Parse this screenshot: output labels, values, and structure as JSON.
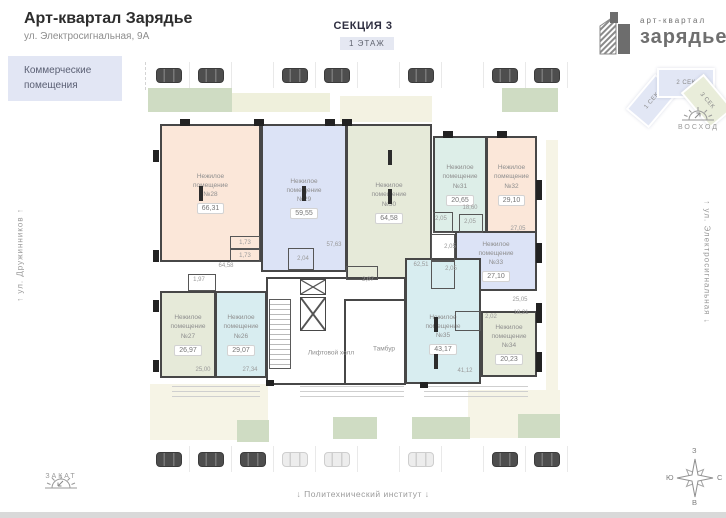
{
  "header": {
    "title": "Арт-квартал Зарядье",
    "subtitle": "ул. Электросигнальная, 9А",
    "badge": "Коммерческие помещения"
  },
  "section_header": {
    "title": "СЕКЦИЯ 3",
    "floor_badge": "1 ЭТАЖ"
  },
  "logo": {
    "top_text": "арт-квартал",
    "bottom_text": "зарядье"
  },
  "section_picker": [
    {
      "label": "1 СЕК",
      "active": false
    },
    {
      "label": "2 СЕК",
      "active": false
    },
    {
      "label": "3 СЕК",
      "active": true
    }
  ],
  "surroundings": {
    "sunrise_label": "ВОСХОД",
    "sunset_label": "ЗАКАТ",
    "street_left": "↑  ул. Дружинников  ↑",
    "street_right": "↑  ул. Электросигнальная  ↓",
    "landmark_bottom": "↓ Политехнический институт ↓",
    "compass": {
      "top": "З",
      "left": "Ю",
      "right": "С",
      "bottom": "В"
    }
  },
  "colors": {
    "peach": "#fbe7d9",
    "lavender": "#dce3f6",
    "sage": "#e6ead9",
    "mint": "#ddeee8",
    "cyan": "#d8edf0"
  },
  "plan": {
    "room_type_label": "Нежилое помещение",
    "rooms": [
      {
        "number": "№28",
        "area": "66,31",
        "color": "peach",
        "rect": [
          160,
          124,
          101,
          138
        ]
      },
      {
        "number": "№29",
        "area": "59,55",
        "color": "lavender",
        "rect": [
          261,
          124,
          86,
          148
        ]
      },
      {
        "number": "№30",
        "area": "64,58",
        "color": "sage",
        "rect": [
          346,
          124,
          86,
          157
        ]
      },
      {
        "number": "№31",
        "area": "20,65",
        "color": "mint",
        "rect": [
          433,
          136,
          54,
          97
        ]
      },
      {
        "number": "№32",
        "area": "29,10",
        "color": "peach",
        "rect": [
          486,
          136,
          51,
          97
        ]
      },
      {
        "number": "№33",
        "area": "27,10",
        "color": "lavender",
        "rect": [
          455,
          231,
          82,
          60
        ]
      },
      {
        "number": "№27",
        "area": "26,97",
        "color": "sage",
        "rect": [
          160,
          291,
          56,
          87
        ]
      },
      {
        "number": "№26",
        "area": "29,07",
        "color": "cyan",
        "rect": [
          215,
          291,
          52,
          87
        ]
      },
      {
        "number": "№35",
        "area": "43,17",
        "color": "cyan",
        "rect": [
          405,
          258,
          76,
          126
        ],
        "padTop": 26
      },
      {
        "number": "№34",
        "area": "20,23",
        "color": "sage",
        "rect": [
          481,
          311,
          56,
          66
        ]
      }
    ],
    "halls": [
      {
        "name": "Лифтовой холл",
        "pos": [
          331,
          353
        ]
      },
      {
        "name": "Тамбур",
        "pos": [
          384,
          349
        ]
      }
    ],
    "small_rooms": [
      [
        230,
        236,
        30,
        13
      ],
      [
        230,
        249,
        30,
        13
      ],
      [
        288,
        248,
        26,
        22
      ],
      [
        346,
        266,
        32,
        14
      ],
      [
        433,
        212,
        20,
        21
      ],
      [
        459,
        214,
        24,
        19
      ],
      [
        431,
        234,
        24,
        27
      ],
      [
        431,
        261,
        24,
        28
      ],
      [
        455,
        311,
        26,
        20
      ],
      [
        188,
        274,
        28,
        17
      ]
    ],
    "sub_labels": [
      {
        "text": "64,58",
        "x": 226,
        "y": 266
      },
      {
        "text": "1,73",
        "x": 245,
        "y": 243
      },
      {
        "text": "1,73",
        "x": 245,
        "y": 256
      },
      {
        "text": "2,04",
        "x": 303,
        "y": 259
      },
      {
        "text": "57,63",
        "x": 334,
        "y": 245
      },
      {
        "text": "62,51",
        "x": 421,
        "y": 265
      },
      {
        "text": "2,07",
        "x": 368,
        "y": 280
      },
      {
        "text": "2,05",
        "x": 441,
        "y": 219
      },
      {
        "text": "18,60",
        "x": 470,
        "y": 208
      },
      {
        "text": "2,05",
        "x": 470,
        "y": 222
      },
      {
        "text": "27,05",
        "x": 518,
        "y": 229
      },
      {
        "text": "2,05",
        "x": 450,
        "y": 247
      },
      {
        "text": "2,05",
        "x": 451,
        "y": 269
      },
      {
        "text": "25,05",
        "x": 520,
        "y": 300
      },
      {
        "text": "2,02",
        "x": 491,
        "y": 317
      },
      {
        "text": "18,21",
        "x": 521,
        "y": 313
      },
      {
        "text": "1,97",
        "x": 199,
        "y": 280
      },
      {
        "text": "25,00",
        "x": 203,
        "y": 370
      },
      {
        "text": "27,34",
        "x": 250,
        "y": 370
      },
      {
        "text": "41,12",
        "x": 465,
        "y": 371
      }
    ],
    "columns": [
      [
        199,
        186
      ],
      [
        302,
        186
      ],
      [
        388,
        150
      ],
      [
        388,
        189
      ],
      [
        434,
        317
      ],
      [
        434,
        354
      ]
    ],
    "wall_marks": [
      [
        180,
        119,
        10,
        7
      ],
      [
        254,
        119,
        10,
        7
      ],
      [
        325,
        119,
        10,
        7
      ],
      [
        342,
        119,
        10,
        7
      ],
      [
        443,
        131,
        10,
        7
      ],
      [
        497,
        131,
        10,
        7
      ],
      [
        153,
        150,
        6,
        12
      ],
      [
        153,
        250,
        6,
        12
      ],
      [
        153,
        300,
        6,
        12
      ],
      [
        153,
        360,
        6,
        12
      ],
      [
        536,
        180,
        6,
        20
      ],
      [
        536,
        243,
        6,
        20
      ],
      [
        536,
        303,
        6,
        20
      ],
      [
        536,
        352,
        6,
        20
      ],
      [
        266,
        380,
        8,
        6
      ],
      [
        420,
        382,
        8,
        6
      ]
    ]
  },
  "parking": {
    "top": [
      "dark",
      "dark",
      "none",
      "dark",
      "dark",
      "none",
      "dark",
      "none",
      "dark",
      "dark"
    ],
    "bottom": [
      "dark",
      "dark",
      "dark",
      "light",
      "light",
      "none",
      "light",
      "none",
      "dark",
      "dark"
    ]
  }
}
